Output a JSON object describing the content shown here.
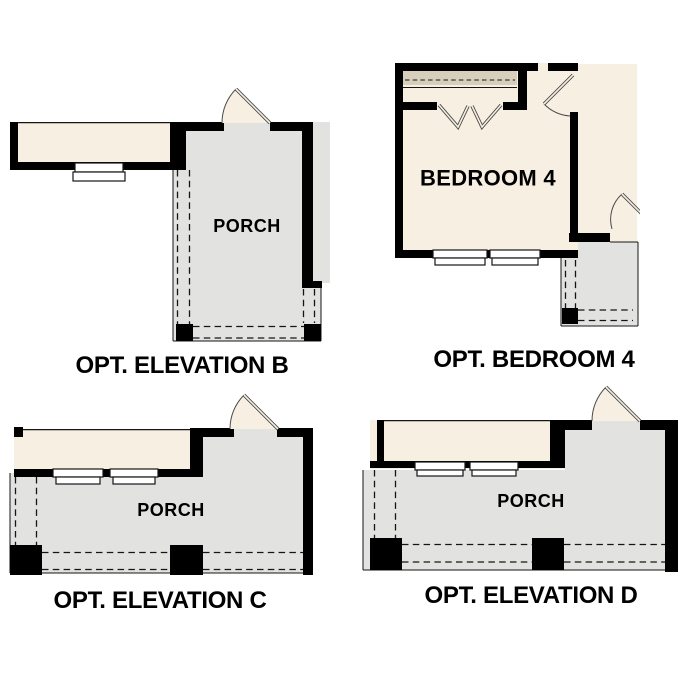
{
  "titles": {
    "elevation_b": "OPT. ELEVATION B",
    "bedroom_4": "OPT. BEDROOM 4",
    "elevation_c": "OPT. ELEVATION C",
    "elevation_d": "OPT. ELEVATION D"
  },
  "labels": {
    "porch_b": "PORCH",
    "bedroom_4": "BEDROOM 4",
    "porch_c": "PORCH",
    "porch_d": "PORCH"
  },
  "colors": {
    "paper": "#ffffff",
    "wall": "#000000",
    "cream": "#f7efe2",
    "tan": "#d8cebc",
    "porch": "#e2e2e0",
    "line": "#151515"
  }
}
